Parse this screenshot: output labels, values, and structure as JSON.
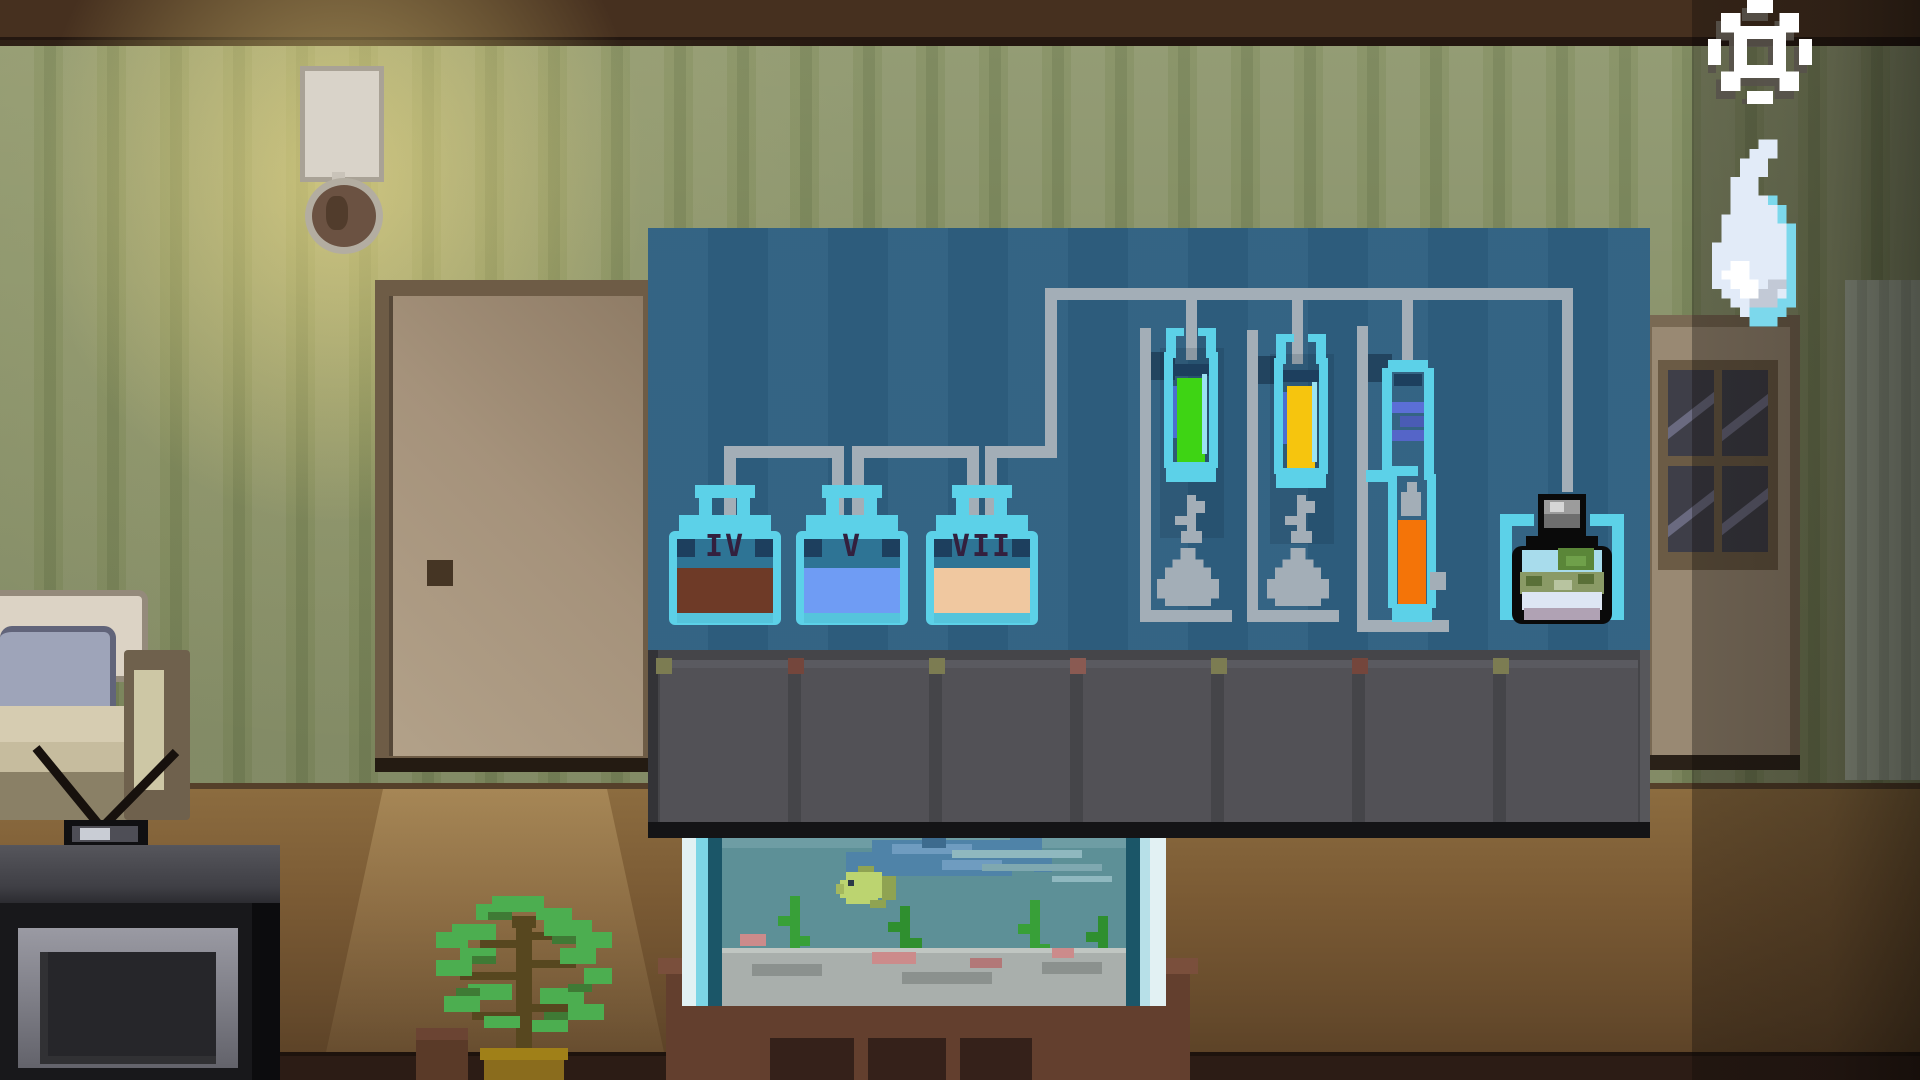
{
  "hud": {
    "settings_icon": "gear",
    "inventory_item": "water-flame"
  },
  "apparatus": {
    "jars": [
      {
        "label": "IV",
        "liquid_color": "#6e3a27",
        "style": "background:#6e3a27"
      },
      {
        "label": "V",
        "liquid_color": "#6f9cf4",
        "style": "background:#6f9cf4"
      },
      {
        "label": "VII",
        "liquid_color": "#f0c8a0",
        "style": "background:#f0c8a0"
      }
    ],
    "tubes": [
      {
        "name": "green-tube",
        "liquid_color": "#3ed414",
        "style": "background:#3ed414"
      },
      {
        "name": "yellow-tube",
        "liquid_color": "#f6c50e",
        "style": "background:#f6c50e"
      },
      {
        "name": "orange-tube",
        "liquid_color": "#f47408",
        "style": "background:#f47408"
      }
    ],
    "condenser_color": "#5b6fd6",
    "bottle": {
      "name": "potion-bottle"
    }
  },
  "colors": {
    "panel": "#2e5f80",
    "pipe": "#a3aeb7",
    "glass_cyan": "#5cd1e8",
    "wall": "#8d966f",
    "cabinet": "#4a4a4e"
  }
}
